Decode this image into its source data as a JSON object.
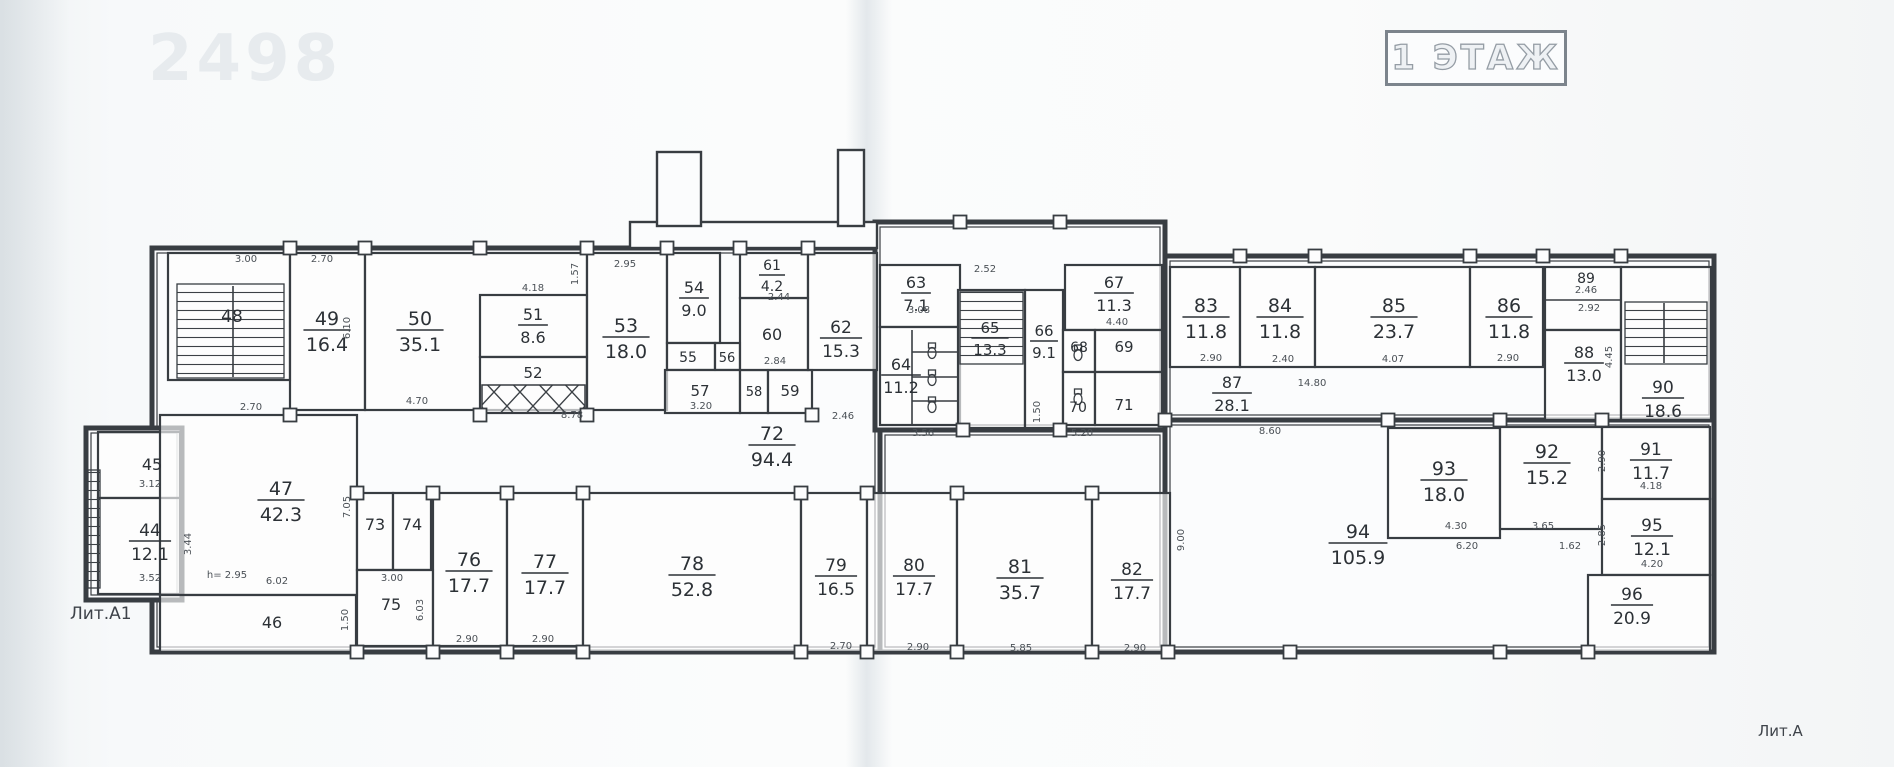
{
  "meta": {
    "title": "1 ЭТАЖ",
    "watermark": "2498",
    "lit_a1": "Лит.А1",
    "lit_a": "Лит.А",
    "ink": "#383d42",
    "dim_color": "#4a5056",
    "label_color": "#2c3136"
  },
  "blocks": [
    {
      "x": 152,
      "y": 248,
      "w": 728,
      "h": 404
    },
    {
      "x": 875,
      "y": 222,
      "w": 290,
      "h": 208
    },
    {
      "x": 880,
      "y": 430,
      "w": 285,
      "h": 222
    },
    {
      "x": 1165,
      "y": 256,
      "w": 549,
      "h": 164
    },
    {
      "x": 1165,
      "y": 420,
      "w": 549,
      "h": 232
    },
    {
      "x": 86,
      "y": 428,
      "w": 96,
      "h": 172
    }
  ],
  "extras": [
    {
      "x": 630,
      "y": 222,
      "w": 247,
      "h": 26
    },
    {
      "x": 657,
      "y": 152,
      "w": 44,
      "h": 74
    },
    {
      "x": 838,
      "y": 150,
      "w": 26,
      "h": 76
    }
  ],
  "rooms": [
    {
      "n": "48",
      "x": 168,
      "y": 253,
      "w": 122,
      "h": 127,
      "kind": "stair",
      "lx": 232,
      "ly": 322,
      "fs": 17
    },
    {
      "n": "49",
      "a": "16.4",
      "x": 290,
      "y": 253,
      "w": 75,
      "h": 157,
      "lx": 327,
      "ly": 325
    },
    {
      "n": "50",
      "a": "35.1",
      "x": 365,
      "y": 253,
      "w": 222,
      "h": 157,
      "lx": 420,
      "ly": 325
    },
    {
      "n": "51",
      "a": "8.6",
      "x": 480,
      "y": 295,
      "w": 107,
      "h": 62,
      "lx": 533,
      "ly": 320,
      "fs": 16
    },
    {
      "n": "52",
      "x": 480,
      "y": 357,
      "w": 107,
      "h": 56,
      "kind": "shaft",
      "lx": 533,
      "ly": 378,
      "fs": 15
    },
    {
      "n": "53",
      "a": "18.0",
      "x": 587,
      "y": 253,
      "w": 80,
      "h": 157,
      "lx": 626,
      "ly": 332
    },
    {
      "n": "54",
      "a": "9.0",
      "x": 667,
      "y": 253,
      "w": 53,
      "h": 90,
      "lx": 694,
      "ly": 293,
      "fs": 16
    },
    {
      "n": "55",
      "x": 667,
      "y": 343,
      "w": 48,
      "h": 27,
      "lx": 688,
      "ly": 362,
      "fs": 14
    },
    {
      "n": "56",
      "x": 715,
      "y": 343,
      "w": 25,
      "h": 27,
      "lx": 727,
      "ly": 362,
      "fs": 13
    },
    {
      "n": "57",
      "x": 665,
      "y": 370,
      "w": 75,
      "h": 43,
      "lx": 700,
      "ly": 396,
      "fs": 15
    },
    {
      "n": "58",
      "x": 740,
      "y": 370,
      "w": 28,
      "h": 43,
      "lx": 754,
      "ly": 396,
      "fs": 13
    },
    {
      "n": "59",
      "x": 768,
      "y": 370,
      "w": 44,
      "h": 43,
      "lx": 790,
      "ly": 396,
      "fs": 15
    },
    {
      "n": "60",
      "x": 740,
      "y": 298,
      "w": 68,
      "h": 72,
      "lx": 772,
      "ly": 340,
      "fs": 16
    },
    {
      "n": "61",
      "a": "4.2",
      "x": 740,
      "y": 253,
      "w": 68,
      "h": 45,
      "lx": 772,
      "ly": 270,
      "fs": 14
    },
    {
      "n": "62",
      "a": "15.3",
      "x": 808,
      "y": 253,
      "w": 69,
      "h": 117,
      "lx": 841,
      "ly": 333,
      "fs": 17
    },
    {
      "n": "72",
      "a": "94.4",
      "kind": "open",
      "lx": 772,
      "ly": 440
    },
    {
      "n": "63",
      "a": "7.1",
      "x": 880,
      "y": 265,
      "w": 80,
      "h": 62,
      "lx": 916,
      "ly": 288,
      "fs": 16
    },
    {
      "n": "64",
      "a": "11.2",
      "x": 880,
      "y": 327,
      "w": 80,
      "h": 98,
      "lx": 901,
      "ly": 370,
      "fs": 16
    },
    {
      "n": "65",
      "a": "13.3",
      "x": 958,
      "y": 290,
      "w": 67,
      "h": 138,
      "kind": "stair",
      "lx": 990,
      "ly": 333,
      "fs": 15
    },
    {
      "n": "66",
      "a": "9.1",
      "x": 1025,
      "y": 290,
      "w": 38,
      "h": 138,
      "lx": 1044,
      "ly": 336,
      "fs": 15
    },
    {
      "n": "67",
      "a": "11.3",
      "x": 1065,
      "y": 265,
      "w": 97,
      "h": 65,
      "lx": 1114,
      "ly": 288,
      "fs": 16
    },
    {
      "n": "68",
      "x": 1063,
      "y": 330,
      "w": 32,
      "h": 42,
      "lx": 1079,
      "ly": 352,
      "fs": 14
    },
    {
      "n": "69",
      "x": 1095,
      "y": 330,
      "w": 67,
      "h": 42,
      "lx": 1124,
      "ly": 352,
      "fs": 15
    },
    {
      "n": "70",
      "x": 1063,
      "y": 372,
      "w": 32,
      "h": 53,
      "lx": 1078,
      "ly": 412,
      "fs": 14
    },
    {
      "n": "71",
      "x": 1095,
      "y": 372,
      "w": 67,
      "h": 53,
      "lx": 1124,
      "ly": 410,
      "fs": 15
    },
    {
      "n": "87",
      "a": "28.1",
      "kind": "open",
      "lx": 1232,
      "ly": 388,
      "fs": 16
    },
    {
      "n": "83",
      "a": "11.8",
      "x": 1170,
      "y": 267,
      "w": 70,
      "h": 100,
      "lx": 1206,
      "ly": 312
    },
    {
      "n": "84",
      "a": "11.8",
      "x": 1240,
      "y": 267,
      "w": 75,
      "h": 100,
      "lx": 1280,
      "ly": 312
    },
    {
      "n": "85",
      "a": "23.7",
      "x": 1315,
      "y": 267,
      "w": 155,
      "h": 100,
      "lx": 1394,
      "ly": 312
    },
    {
      "n": "86",
      "a": "11.8",
      "x": 1470,
      "y": 267,
      "w": 73,
      "h": 100,
      "lx": 1509,
      "ly": 312
    },
    {
      "n": "89",
      "x": 1545,
      "y": 267,
      "w": 76,
      "h": 63,
      "lx": 1586,
      "ly": 283,
      "fs": 14
    },
    {
      "n": "88",
      "a": "13.0",
      "x": 1545,
      "y": 330,
      "w": 76,
      "h": 90,
      "lx": 1584,
      "ly": 358,
      "fs": 16
    },
    {
      "n": "90",
      "a": "18.6",
      "x": 1621,
      "y": 267,
      "w": 90,
      "h": 153,
      "kind": "stair",
      "lx": 1663,
      "ly": 393,
      "fs": 17
    },
    {
      "n": "94",
      "a": "105.9",
      "kind": "open",
      "lx": 1358,
      "ly": 538
    },
    {
      "n": "93",
      "a": "18.0",
      "x": 1388,
      "y": 428,
      "w": 112,
      "h": 110,
      "lx": 1444,
      "ly": 475
    },
    {
      "n": "92",
      "a": "15.2",
      "x": 1500,
      "y": 427,
      "w": 102,
      "h": 102,
      "lx": 1547,
      "ly": 458
    },
    {
      "n": "91",
      "a": "11.7",
      "x": 1602,
      "y": 427,
      "w": 108,
      "h": 72,
      "lx": 1651,
      "ly": 455,
      "fs": 17
    },
    {
      "n": "95",
      "a": "12.1",
      "x": 1602,
      "y": 499,
      "w": 108,
      "h": 76,
      "lx": 1652,
      "ly": 531,
      "fs": 17
    },
    {
      "n": "96",
      "a": "20.9",
      "x": 1588,
      "y": 575,
      "w": 122,
      "h": 77,
      "lx": 1632,
      "ly": 600,
      "fs": 17
    },
    {
      "n": "45",
      "x": 98,
      "y": 432,
      "w": 82,
      "h": 66,
      "lx": 152,
      "ly": 470,
      "fs": 16
    },
    {
      "n": "44",
      "a": "12.1",
      "x": 98,
      "y": 498,
      "w": 82,
      "h": 96,
      "lx": 150,
      "ly": 536,
      "fs": 17
    },
    {
      "n": "47",
      "a": "42.3",
      "x": 160,
      "y": 415,
      "w": 197,
      "h": 180,
      "lx": 281,
      "ly": 495
    },
    {
      "n": "46",
      "x": 160,
      "y": 595,
      "w": 196,
      "h": 57,
      "lx": 272,
      "ly": 628,
      "fs": 16
    },
    {
      "n": "73",
      "x": 357,
      "y": 493,
      "w": 36,
      "h": 77,
      "lx": 375,
      "ly": 530,
      "fs": 16
    },
    {
      "n": "74",
      "x": 393,
      "y": 493,
      "w": 38,
      "h": 77,
      "lx": 412,
      "ly": 530,
      "fs": 16
    },
    {
      "n": "75",
      "x": 357,
      "y": 570,
      "w": 76,
      "h": 76,
      "lx": 391,
      "ly": 610,
      "fs": 16
    },
    {
      "n": "76",
      "a": "17.7",
      "x": 433,
      "y": 493,
      "w": 74,
      "h": 153,
      "lx": 469,
      "ly": 566
    },
    {
      "n": "77",
      "a": "17.7",
      "x": 507,
      "y": 493,
      "w": 76,
      "h": 153,
      "lx": 545,
      "ly": 568
    },
    {
      "n": "78",
      "a": "52.8",
      "x": 583,
      "y": 493,
      "w": 218,
      "h": 159,
      "lx": 692,
      "ly": 570
    },
    {
      "n": "79",
      "a": "16.5",
      "x": 801,
      "y": 493,
      "w": 66,
      "h": 159,
      "lx": 836,
      "ly": 571,
      "fs": 17
    },
    {
      "n": "80",
      "a": "17.7",
      "x": 867,
      "y": 493,
      "w": 90,
      "h": 159,
      "lx": 914,
      "ly": 571,
      "fs": 17
    },
    {
      "n": "81",
      "a": "35.7",
      "x": 957,
      "y": 493,
      "w": 135,
      "h": 159,
      "lx": 1020,
      "ly": 573
    },
    {
      "n": "82",
      "a": "17.7",
      "x": 1092,
      "y": 493,
      "w": 78,
      "h": 159,
      "lx": 1132,
      "ly": 575,
      "fs": 17
    }
  ],
  "hatches": [
    {
      "x": 177,
      "y": 284,
      "w": 107,
      "h": 94
    },
    {
      "x": 960,
      "y": 292,
      "w": 63,
      "h": 72
    },
    {
      "x": 1625,
      "y": 302,
      "w": 82,
      "h": 62
    },
    {
      "x": 88,
      "y": 470,
      "w": 12,
      "h": 118
    }
  ],
  "shafts": [
    {
      "x": 482,
      "y": 385,
      "w": 103,
      "h": 28
    }
  ],
  "lines": [
    {
      "x1": 233,
      "y1": 286,
      "x2": 233,
      "y2": 377
    },
    {
      "x1": 1664,
      "y1": 303,
      "x2": 1664,
      "y2": 363
    },
    {
      "x1": 912,
      "y1": 330,
      "x2": 912,
      "y2": 425
    },
    {
      "x1": 912,
      "y1": 352,
      "x2": 958,
      "y2": 352
    },
    {
      "x1": 912,
      "y1": 377,
      "x2": 958,
      "y2": 377
    },
    {
      "x1": 912,
      "y1": 401,
      "x2": 958,
      "y2": 401
    },
    {
      "x1": 1545,
      "y1": 300,
      "x2": 1621,
      "y2": 300
    }
  ],
  "wc": [
    {
      "x": 932,
      "y": 350
    },
    {
      "x": 932,
      "y": 377
    },
    {
      "x": 932,
      "y": 404
    },
    {
      "x": 1078,
      "y": 352
    },
    {
      "x": 1078,
      "y": 396
    }
  ],
  "piers": [
    {
      "x": 290,
      "y": 248
    },
    {
      "x": 365,
      "y": 248
    },
    {
      "x": 480,
      "y": 248
    },
    {
      "x": 587,
      "y": 248
    },
    {
      "x": 667,
      "y": 248
    },
    {
      "x": 740,
      "y": 248
    },
    {
      "x": 808,
      "y": 248
    },
    {
      "x": 960,
      "y": 222
    },
    {
      "x": 1060,
      "y": 222
    },
    {
      "x": 1240,
      "y": 256
    },
    {
      "x": 1315,
      "y": 256
    },
    {
      "x": 1470,
      "y": 256
    },
    {
      "x": 1543,
      "y": 256
    },
    {
      "x": 1621,
      "y": 256
    },
    {
      "x": 290,
      "y": 415
    },
    {
      "x": 480,
      "y": 415
    },
    {
      "x": 587,
      "y": 415
    },
    {
      "x": 812,
      "y": 415
    },
    {
      "x": 357,
      "y": 493
    },
    {
      "x": 433,
      "y": 493
    },
    {
      "x": 507,
      "y": 493
    },
    {
      "x": 583,
      "y": 493
    },
    {
      "x": 801,
      "y": 493
    },
    {
      "x": 867,
      "y": 493
    },
    {
      "x": 957,
      "y": 493
    },
    {
      "x": 1092,
      "y": 493
    },
    {
      "x": 1165,
      "y": 420
    },
    {
      "x": 1388,
      "y": 420
    },
    {
      "x": 1500,
      "y": 420
    },
    {
      "x": 1602,
      "y": 420
    },
    {
      "x": 963,
      "y": 430
    },
    {
      "x": 1060,
      "y": 430
    },
    {
      "x": 357,
      "y": 652
    },
    {
      "x": 433,
      "y": 652
    },
    {
      "x": 507,
      "y": 652
    },
    {
      "x": 583,
      "y": 652
    },
    {
      "x": 801,
      "y": 652
    },
    {
      "x": 867,
      "y": 652
    },
    {
      "x": 957,
      "y": 652
    },
    {
      "x": 1092,
      "y": 652
    },
    {
      "x": 1168,
      "y": 652
    },
    {
      "x": 1290,
      "y": 652
    },
    {
      "x": 1500,
      "y": 652
    },
    {
      "x": 1588,
      "y": 652
    }
  ],
  "dims": [
    {
      "t": "3.00",
      "x": 246,
      "y": 262
    },
    {
      "t": "2.70",
      "x": 322,
      "y": 262
    },
    {
      "t": "4.18",
      "x": 533,
      "y": 291
    },
    {
      "t": "1.57",
      "x": 578,
      "y": 274,
      "r": 1
    },
    {
      "t": "2.95",
      "x": 625,
      "y": 267
    },
    {
      "t": "2.52",
      "x": 985,
      "y": 272
    },
    {
      "t": "2.44",
      "x": 779,
      "y": 300
    },
    {
      "t": "2.84",
      "x": 775,
      "y": 364
    },
    {
      "t": "3.20",
      "x": 701,
      "y": 409
    },
    {
      "t": "4.70",
      "x": 417,
      "y": 404
    },
    {
      "t": "6.10",
      "x": 350,
      "y": 328,
      "r": 1
    },
    {
      "t": "2.46",
      "x": 843,
      "y": 419
    },
    {
      "t": "3.08",
      "x": 919,
      "y": 313
    },
    {
      "t": "4.40",
      "x": 1117,
      "y": 325
    },
    {
      "t": "3.56",
      "x": 923,
      "y": 436
    },
    {
      "t": "5.20",
      "x": 1082,
      "y": 436
    },
    {
      "t": "1.50",
      "x": 1040,
      "y": 412,
      "r": 1
    },
    {
      "t": "2.90",
      "x": 1211,
      "y": 361
    },
    {
      "t": "2.40",
      "x": 1283,
      "y": 362
    },
    {
      "t": "4.07",
      "x": 1393,
      "y": 362
    },
    {
      "t": "2.90",
      "x": 1508,
      "y": 361
    },
    {
      "t": "2.46",
      "x": 1586,
      "y": 293
    },
    {
      "t": "2.92",
      "x": 1589,
      "y": 311
    },
    {
      "t": "4.45",
      "x": 1612,
      "y": 357,
      "r": 1
    },
    {
      "t": "14.80",
      "x": 1312,
      "y": 386
    },
    {
      "t": "8.60",
      "x": 1270,
      "y": 434
    },
    {
      "t": "9.00",
      "x": 1184,
      "y": 540,
      "r": 1
    },
    {
      "t": "4.30",
      "x": 1456,
      "y": 529
    },
    {
      "t": "6.20",
      "x": 1467,
      "y": 549
    },
    {
      "t": "3.65",
      "x": 1543,
      "y": 529
    },
    {
      "t": "1.62",
      "x": 1570,
      "y": 549
    },
    {
      "t": "2.90",
      "x": 1605,
      "y": 461,
      "r": 1
    },
    {
      "t": "4.18",
      "x": 1651,
      "y": 489
    },
    {
      "t": "2.85",
      "x": 1605,
      "y": 535,
      "r": 1
    },
    {
      "t": "4.20",
      "x": 1652,
      "y": 567
    },
    {
      "t": "2.70",
      "x": 251,
      "y": 410
    },
    {
      "t": "3.12",
      "x": 150,
      "y": 487
    },
    {
      "t": "3.44",
      "x": 191,
      "y": 544,
      "r": 1
    },
    {
      "t": "3.52",
      "x": 150,
      "y": 581
    },
    {
      "t": "h= 2.95",
      "x": 227,
      "y": 578
    },
    {
      "t": "6.02",
      "x": 277,
      "y": 584
    },
    {
      "t": "7.05",
      "x": 350,
      "y": 507,
      "r": 1
    },
    {
      "t": "3.00",
      "x": 392,
      "y": 581
    },
    {
      "t": "1.50",
      "x": 348,
      "y": 620,
      "r": 1
    },
    {
      "t": "6.03",
      "x": 423,
      "y": 610,
      "r": 1
    },
    {
      "t": "2.90",
      "x": 467,
      "y": 642
    },
    {
      "t": "2.90",
      "x": 543,
      "y": 642
    },
    {
      "t": "8.78",
      "x": 572,
      "y": 418
    },
    {
      "t": "2.70",
      "x": 841,
      "y": 649
    },
    {
      "t": "2.90",
      "x": 918,
      "y": 650
    },
    {
      "t": "5.85",
      "x": 1021,
      "y": 651
    },
    {
      "t": "2.90",
      "x": 1135,
      "y": 651
    }
  ]
}
